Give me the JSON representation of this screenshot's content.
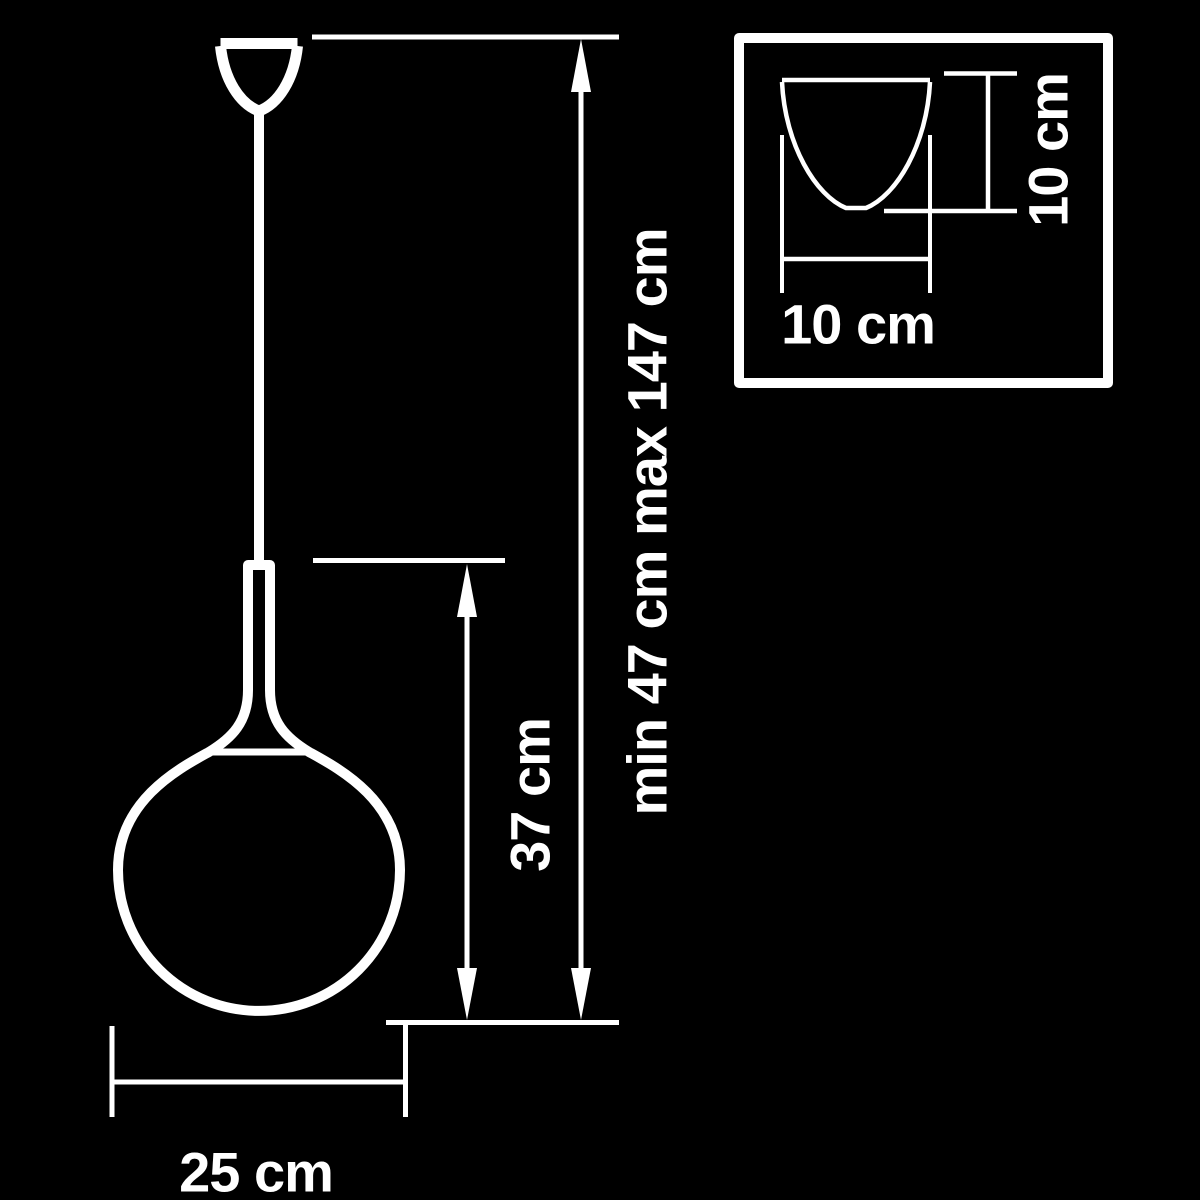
{
  "colors": {
    "background": "#000000",
    "line": "#ffffff"
  },
  "labels": {
    "suspension_height": "min 47 cm max 147 cm",
    "shade_height": "37 cm",
    "shade_diameter": "25 cm",
    "canopy_width": "10 cm",
    "canopy_height": "10 cm"
  }
}
